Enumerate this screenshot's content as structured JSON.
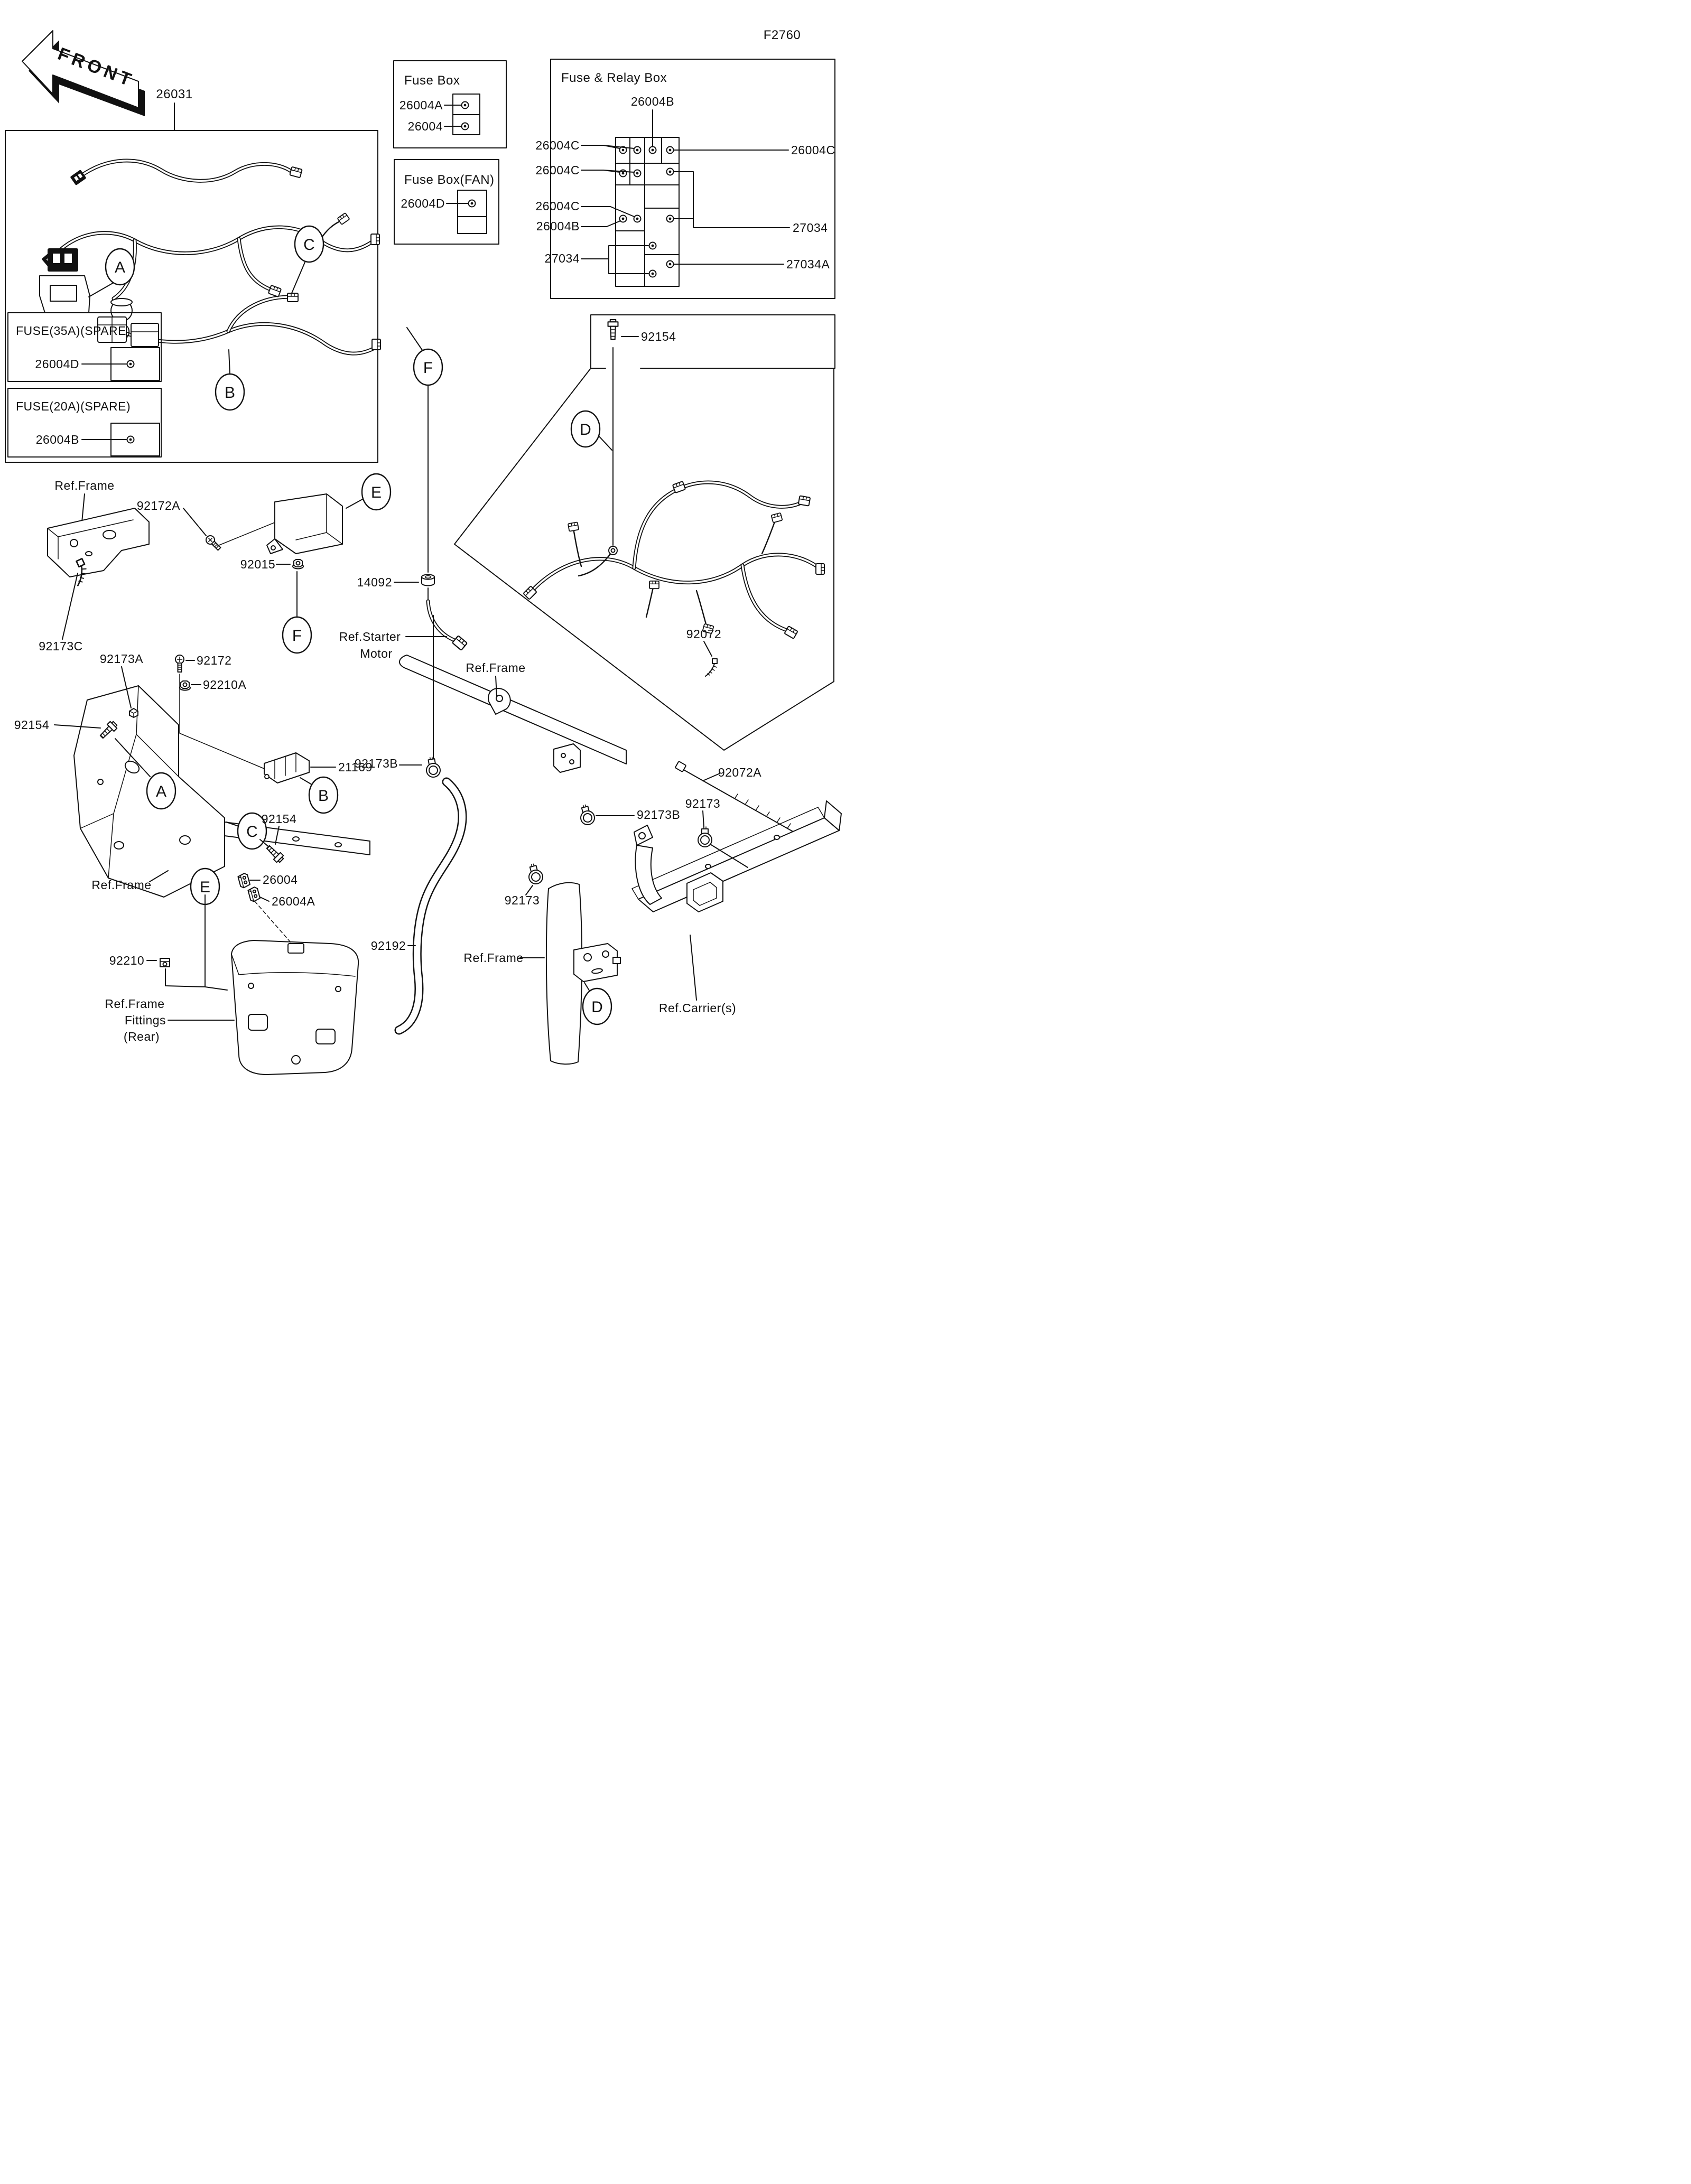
{
  "page": {
    "code": "F2760"
  },
  "front_arrow": {
    "label": "FRONT"
  },
  "harness": {
    "part_no": "26031"
  },
  "fuse_box": {
    "title": "Fuse Box",
    "slots": [
      {
        "part": "26004A"
      },
      {
        "part": "26004"
      }
    ]
  },
  "fuse_box_fan": {
    "title": "Fuse Box(FAN)",
    "slots": [
      {
        "part": "26004D"
      }
    ]
  },
  "fuse_relay_box": {
    "title": "Fuse & Relay Box",
    "top_part": "26004B",
    "left_parts": [
      {
        "part": "26004C"
      },
      {
        "part": "26004C"
      },
      {
        "part": "26004C"
      },
      {
        "part": "26004B"
      },
      {
        "part": "27034"
      }
    ],
    "right_parts": [
      {
        "part": "26004C"
      },
      {
        "part": "27034"
      },
      {
        "part": "27034A"
      }
    ]
  },
  "spare_fuse_boxes": [
    {
      "title": "FUSE(35A)(SPARE)",
      "part": "26004D"
    },
    {
      "title": "FUSE(20A)(SPARE)",
      "part": "26004B"
    }
  ],
  "fasteners": {
    "bolt_top": "92154",
    "screw_a": "92172A",
    "nut": "92015",
    "grommet": "14092",
    "band_c": "92173C",
    "damper_a": "92173A",
    "screw": "92172",
    "nut_a": "92210A",
    "bolt_left": "92154",
    "junction": "21169",
    "bolt_c": "92154",
    "fuse": "26004",
    "fuse_a": "26004A",
    "nut_clip": "92210",
    "hose": "92192",
    "band": "92072",
    "band_a": "92072A",
    "clamp_b1": "92173B",
    "clamp_b2": "92173B",
    "clamp_left": "92173",
    "clamp_right": "92173"
  },
  "references": {
    "frame_upper": "Ref.Frame",
    "starter_motor": [
      "Ref.Starter",
      "Motor"
    ],
    "frame_bottom_left": "Ref.Frame",
    "frame_mid": "Ref.Frame",
    "frame_fittings": [
      "Ref.Frame",
      "Fittings",
      "(Rear)"
    ],
    "frame_post": "Ref.Frame",
    "carrier": "Ref.Carrier(s)"
  },
  "callouts": {
    "a": "A",
    "b": "B",
    "c": "C",
    "d": "D",
    "e": "E",
    "f": "F"
  }
}
